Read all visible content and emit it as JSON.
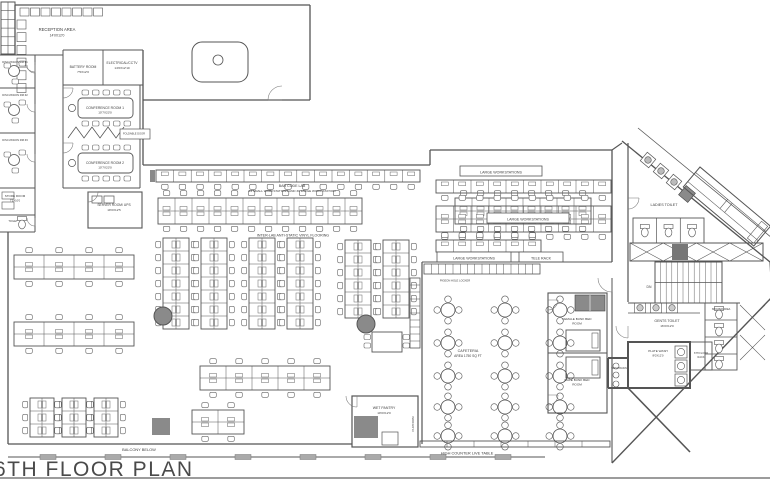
{
  "title": "6TH FLOOR PLAN",
  "colors": {
    "line": "#555555",
    "dark_fill": "#8a8a8a",
    "title_text": "#4a4a4a"
  },
  "rooms": {
    "reception": {
      "name": "RECEPTION AREA",
      "dim": "14'0X12'0"
    },
    "battery": {
      "name": "BATTERY ROOM",
      "dim": "7'5X12'0"
    },
    "electrical": {
      "name": "ELECTRICAL/CCTV",
      "dim": "14'0X12'10"
    },
    "conference1": {
      "name": "CONFERENCE ROOM 1",
      "dim": "10'7X23'0"
    },
    "conference2": {
      "name": "CONFERENCE ROOM 2",
      "dim": "10'7X23'0"
    },
    "foldable_door": {
      "name": "FOLDABLE DOOR"
    },
    "discussion1": {
      "name": "DISCUSSION RM #1"
    },
    "discussion2": {
      "name": "DISCUSSION RM #2"
    },
    "discussion3": {
      "name": "DISCUSSION RM #3"
    },
    "store": {
      "name": "STORE ROOM",
      "dim": "7'5X10'0"
    },
    "toilet": {
      "name": "TOILET"
    },
    "server": {
      "name": "SERVER ROOM/ UPS",
      "dim": "19'0X12'5"
    },
    "barcode_lab": {
      "name": "BAR CODE LAB",
      "sub": "14 SMALL WORKSTATIONS AND 30 LARGE WORK STATION"
    },
    "interlab": {
      "name": "INTER-LAB ANTI-STATIC VINYL FLOORING"
    },
    "large_ws": {
      "name": "LARGE WORKSTATIONS"
    },
    "tele_rack": {
      "name": "TELE RACK"
    },
    "pigeon_locker": {
      "name": "PIGEON HOLE LOCKER"
    },
    "cafeteria": {
      "name": "CAFETERIA",
      "dim": "AREA 1750 SQ FT"
    },
    "female_bunk": {
      "name": "FEMALE BUNK BED",
      "name2": "ROOM"
    },
    "male_bunk": {
      "name": "MALE BUNK BED",
      "name2": "ROOM"
    },
    "ladies_toilet": {
      "name": "LADIES TOILET"
    },
    "gents_toilet": {
      "name": "GENTS TOILET",
      "dim": "16'0X12'0"
    },
    "shower": {
      "name": "SHOWER AREA"
    },
    "plate_wash": {
      "name": "PLATE WASH",
      "dim": "8'0X12'0"
    },
    "wash_basin": {
      "name": "WASH BASIN"
    },
    "floor_rack": {
      "name": "6TH FLOOR",
      "name2": "RACK"
    },
    "wet_pantry": {
      "name": "WET PANTRY",
      "dim": "10'0X12'0"
    },
    "platform": {
      "name": "PLATFORM"
    },
    "balcony": {
      "name": "BALCONY BELOW"
    },
    "high_counter": {
      "name": "HIGH COUNTER LIVE TABLE"
    },
    "stairs": {
      "name": "DN"
    }
  }
}
